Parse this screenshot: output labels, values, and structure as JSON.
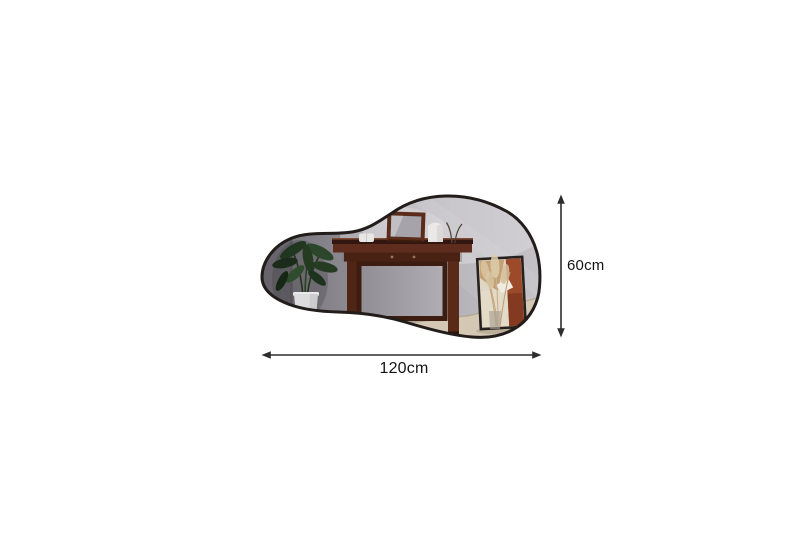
{
  "page": {
    "background_color": "#ffffff",
    "title": "Asymmetric mirror dimension diagram"
  },
  "diagram": {
    "product": "asymmetric-organic-wall-mirror",
    "frame_color": "#221d1a",
    "glass_left_color": "#8e8c92",
    "glass_right_color": "#c6c4c9",
    "reflection_scene": [
      "potted-plant",
      "console-table",
      "tabletop-vanity-mirror",
      "candles",
      "white-jar",
      "framed-artwork",
      "dried-pampas-grass"
    ]
  },
  "dimensions": {
    "width": {
      "label": "120cm",
      "value": 120,
      "unit": "cm"
    },
    "height": {
      "label": "60cm",
      "value": 60,
      "unit": "cm"
    },
    "line_color": "#2d2d2d",
    "text_color": "#141414"
  }
}
